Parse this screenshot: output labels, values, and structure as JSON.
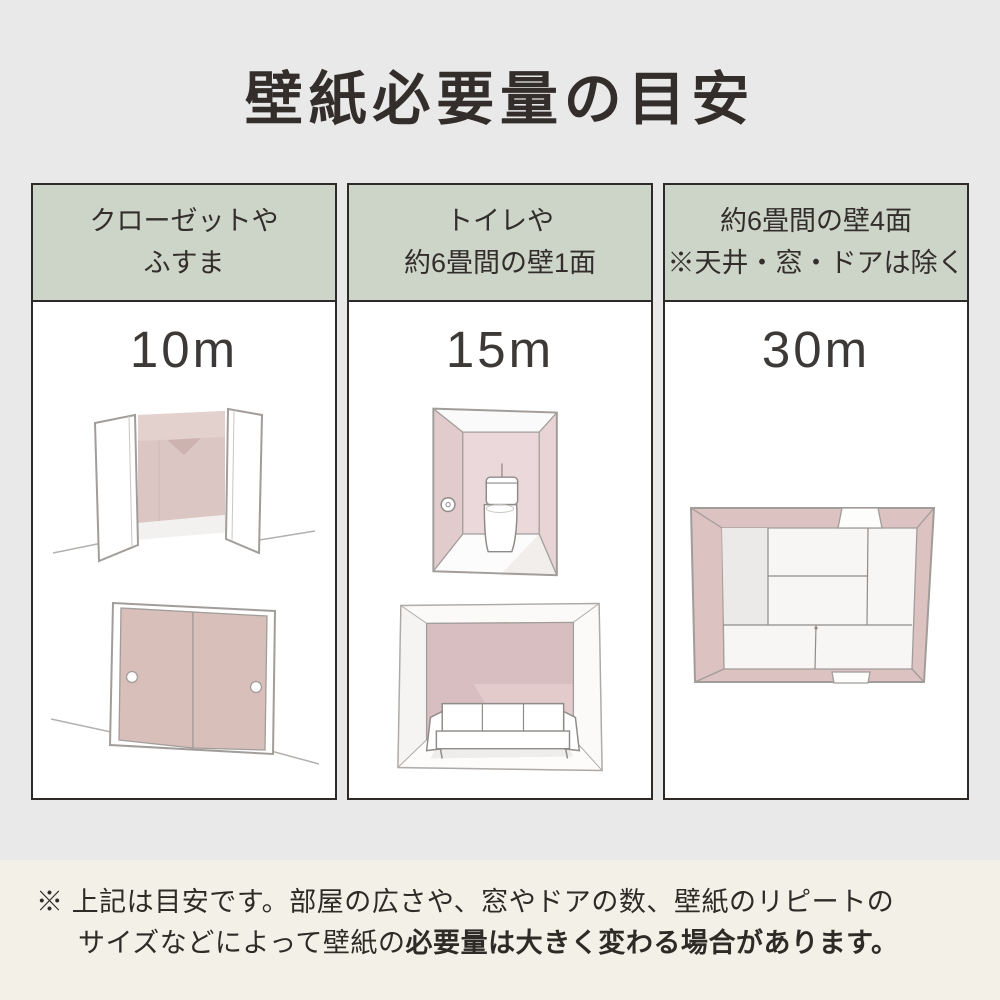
{
  "title": "壁紙必要量の目安",
  "columns": [
    {
      "header": [
        "クローゼットや",
        "ふすま"
      ],
      "value": "10m",
      "illustrations": [
        "open-closet",
        "fusuma-sliding-doors"
      ]
    },
    {
      "header": [
        "トイレや",
        "約6畳間の壁1面"
      ],
      "value": "15m",
      "illustrations": [
        "toilet-room",
        "living-room-one-wall"
      ]
    },
    {
      "header": [
        "約6畳間の壁4面",
        "※天井・窓・ドアは除く"
      ],
      "value": "30m",
      "illustrations": [
        "tatami-room-top-view"
      ]
    }
  ],
  "footnote": {
    "marker": "※ ",
    "line1": "上記は目安です。部屋の広さや、窓やドアの数、壁紙のリピートの",
    "line2_normal": "サイズなどによって壁紙の",
    "line2_bold": "必要量は大きく変わる場合があります。"
  },
  "colors": {
    "page_background": "#e9e9e9",
    "bottom_band": "#f3f0e7",
    "header_band": "#cdd5c8",
    "border": "#2d2a27",
    "text": "#332e2b",
    "wallpaper_pink": "#dcc2c0",
    "fusuma_pink": "#d8bfba",
    "wall_pink_light": "#ebd8da"
  }
}
